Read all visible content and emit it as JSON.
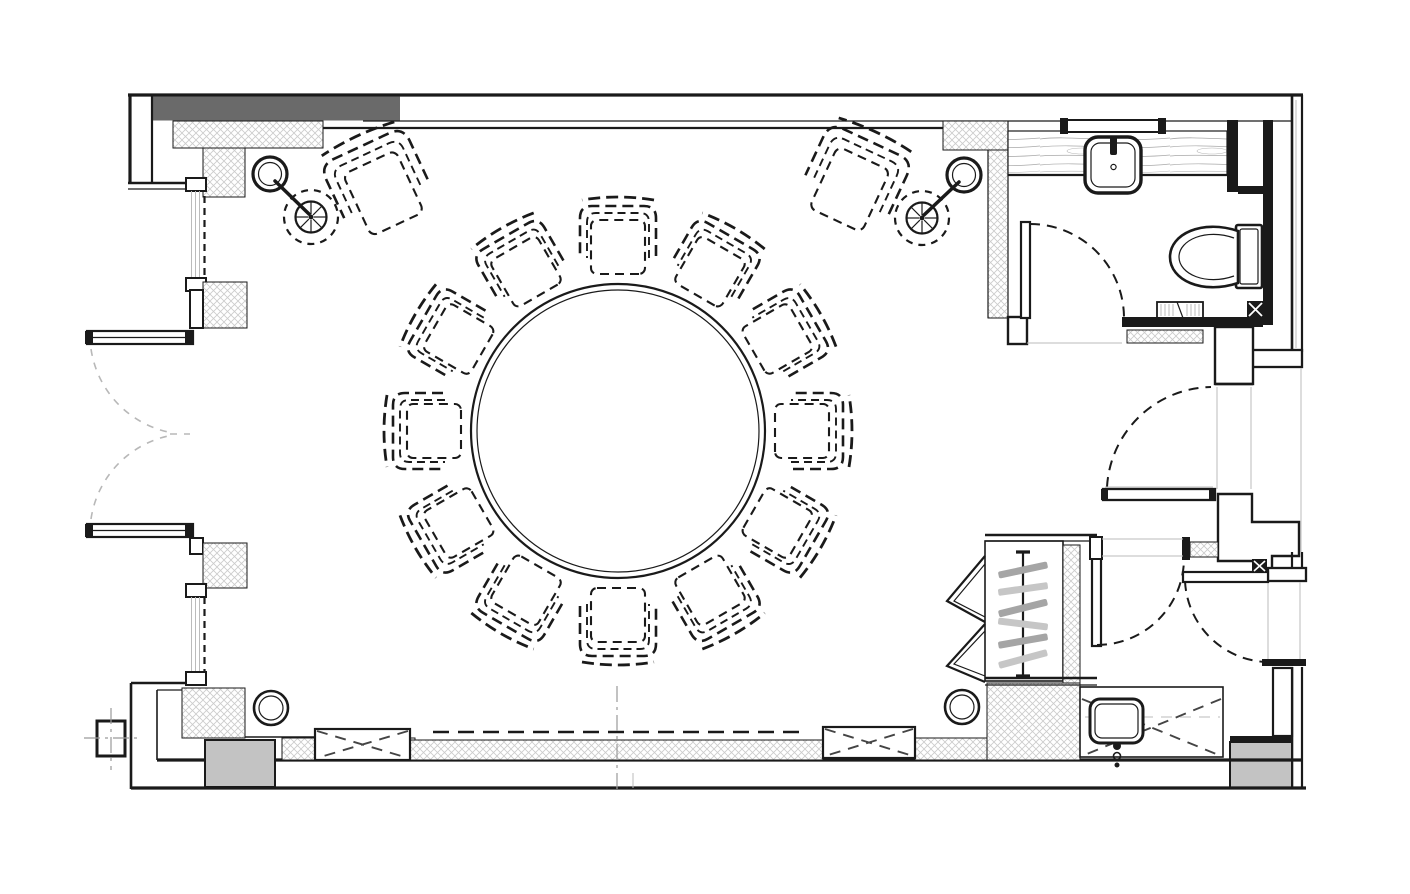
{
  "document": {
    "type": "architectural-floor-plan",
    "view": "plan-view",
    "canvas": {
      "width": 1410,
      "height": 894
    },
    "visible_text": []
  },
  "palette": {
    "ink": "#1a1a1a",
    "wall_band_gray": "#6a6a6a",
    "light_block_gray": "#c3c3c3",
    "hatch_line": "#cbcbcb",
    "wood_grain": "#a8a8a8",
    "faint_line": "#bbbbbb",
    "swing_arc_gray": "#b8b8b8",
    "hanger_gray": "#a5a5a5"
  },
  "conference": {
    "table": {
      "cx": 618,
      "cy": 431,
      "r_outer": 147,
      "r_inner": 141
    },
    "chairs": {
      "count": 12,
      "ring_radius": 187,
      "start_deg": -90,
      "step_deg": 30
    }
  },
  "lounge_sets": [
    {
      "side": "left",
      "chair": {
        "x": 380,
        "y": 186,
        "rot": 155
      },
      "lamp": {
        "x": 270,
        "y": 174
      },
      "arm": {
        "x1": 275,
        "y1": 181,
        "x2": 309,
        "y2": 214
      },
      "side_table": {
        "x": 311,
        "y": 217
      }
    },
    {
      "side": "right",
      "chair": {
        "x": 853,
        "y": 182,
        "rot": 205
      },
      "lamp": {
        "x": 964,
        "y": 175
      },
      "arm": {
        "x1": 959,
        "y1": 182,
        "x2": 924,
        "y2": 215
      },
      "side_table": {
        "x": 922,
        "y": 218
      }
    }
  ],
  "side_table_style": {
    "spokes": 8,
    "r_dashed": 27,
    "r_solid": 15.5
  },
  "ceiling_lights": [
    {
      "x": 271,
      "y": 708
    },
    {
      "x": 962,
      "y": 707
    }
  ],
  "closet": {
    "rod": {
      "x": 1023,
      "y1": 552,
      "y2": 676
    },
    "door_type": "bifold",
    "hangers": [
      {
        "y": 570,
        "rot": -12,
        "tone": "dark"
      },
      {
        "y": 589,
        "rot": -8,
        "tone": "light"
      },
      {
        "y": 608,
        "rot": -14,
        "tone": "dark"
      },
      {
        "y": 624,
        "rot": 7,
        "tone": "light"
      },
      {
        "y": 641,
        "rot": -10,
        "tone": "dark"
      },
      {
        "y": 659,
        "rot": -15,
        "tone": "light"
      }
    ]
  },
  "bathroom": {
    "fixtures": [
      "vanity-counter",
      "vessel-sink",
      "mirror",
      "toilet",
      "wall-grille",
      "floor-drain",
      "swing-door"
    ]
  },
  "kitchenette": {
    "fixtures": [
      "counter-dashed-casework",
      "drop-in-sink",
      "faucet"
    ]
  },
  "doors": {
    "exterior_double_doors_left": 2,
    "bathroom_door": 1,
    "corridor_doors": 3,
    "closet_bifold_panels": 2
  },
  "windows": {
    "left_wall_windows": 2
  }
}
